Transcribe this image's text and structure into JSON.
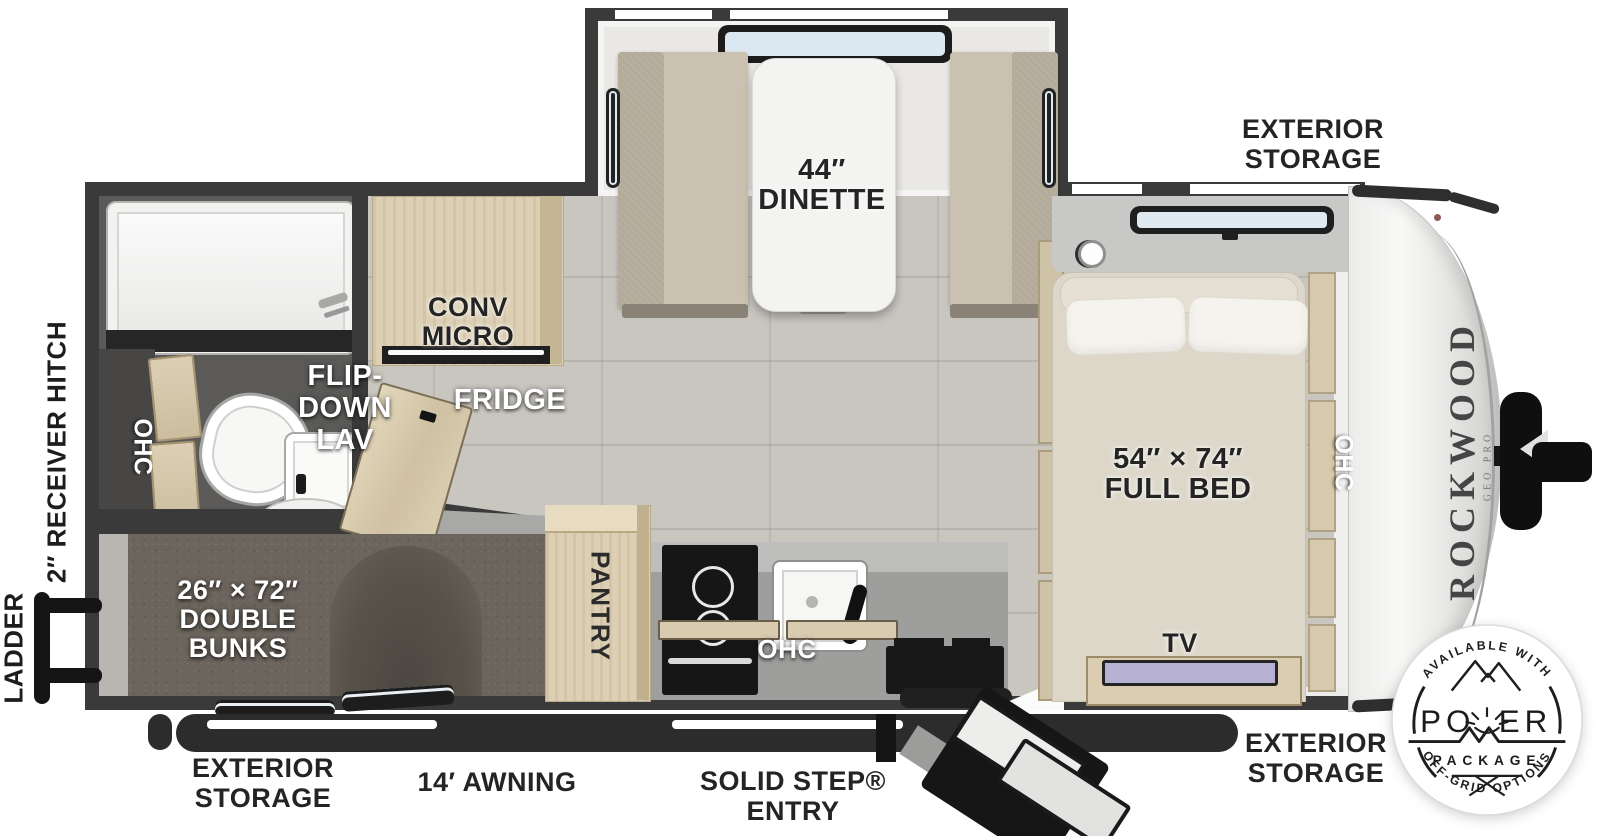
{
  "colors": {
    "wall": "#3a3a3a",
    "floor_tile": "#c9c6c0",
    "carpet": "#6c655d",
    "wood": "#dccfb4",
    "counter": "#9e9e9c",
    "fabric": "#cac1b0",
    "mattress": "#dcd7c9",
    "window_glass": "#dce8f1",
    "label_dark": "#242424",
    "label_white": "#ffffff"
  },
  "labels": {
    "exterior": "EXTERIOR",
    "storage": "STORAGE",
    "dinette_size": "44″",
    "dinette": "DINETTE",
    "conv1": "CONV",
    "conv2": "MICRO",
    "fridge": "FRIDGE",
    "flip1": "FLIP-",
    "flip2": "DOWN",
    "flip3": "LAV",
    "ohc": "OHC",
    "bunks_size": "26″ × 72″",
    "bunks1": "DOUBLE",
    "bunks2": "BUNKS",
    "pantry": "PANTRY",
    "bed_size": "54″ × 74″",
    "bed": "FULL BED",
    "tv": "TV",
    "receiver_hitch": "2″ RECEIVER HITCH",
    "ladder": "LADDER",
    "awning": "14′ AWNING",
    "solid_step1": "SOLID STEP®",
    "solid_step2": "ENTRY"
  },
  "brand": {
    "name": "ROCKWOOD",
    "sub": "GEO PRO"
  },
  "badge": {
    "top": "AVAILABLE WITH",
    "power": "POWER",
    "power_left": "PO",
    "power_right": "ER",
    "package": "PACKAGE",
    "bottom": "OFF-GRID OPTIONS"
  }
}
